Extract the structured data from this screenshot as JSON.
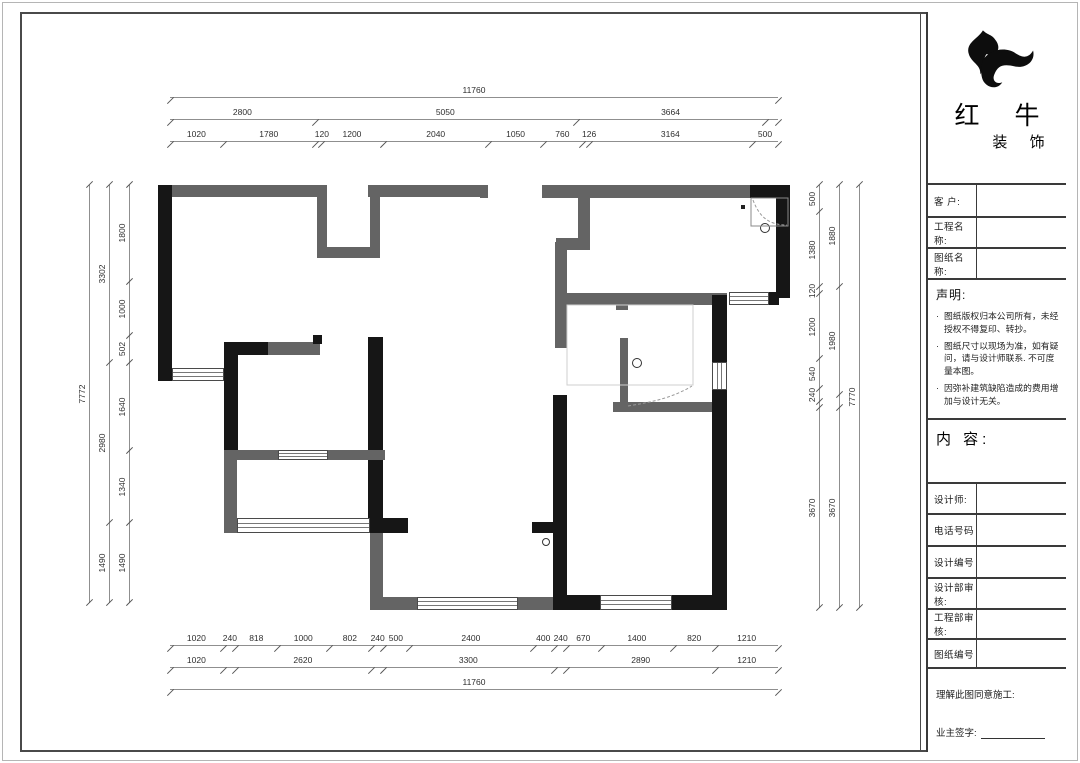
{
  "title_block": {
    "logo": {
      "icon": "bull-swoosh-logo",
      "name_main": "红 牛",
      "name_sub": "装 饰"
    },
    "fields_top": [
      {
        "label": "客  户:"
      },
      {
        "label": "工程名称:"
      },
      {
        "label": "图纸名称:"
      }
    ],
    "statement": {
      "title": "声明:",
      "bullet": "·",
      "items": [
        "图纸版权归本公司所有，未经授权不得复印、转抄。",
        "图纸尺寸以现场为准，如有疑问，请与设计师联系. 不可度量本图。",
        "因弥补建筑缺陷造成的费用增加与设计无关。"
      ]
    },
    "content_label": "内 容:",
    "fields_bottom": [
      {
        "label": "设计师:"
      },
      {
        "label": "电话号码"
      },
      {
        "label": "设计编号"
      },
      {
        "label": "设计部审核:"
      },
      {
        "label": "工程部审核:"
      },
      {
        "label": "图纸编号"
      }
    ],
    "signature": {
      "line1": "理解此图同意施工:",
      "line2": "业主签字:"
    }
  },
  "dims": {
    "top": [
      [
        [
          11760,
          "11760"
        ]
      ],
      [
        [
          2800,
          "2800"
        ],
        [
          5050,
          "5050"
        ],
        [
          3664,
          "3664"
        ],
        [
          246,
          ""
        ]
      ],
      [
        [
          1020,
          "1020"
        ],
        [
          1780,
          "1780"
        ],
        [
          120,
          "120"
        ],
        [
          1200,
          "1200"
        ],
        [
          2040,
          "2040"
        ],
        [
          1050,
          "1050"
        ],
        [
          760,
          "760"
        ],
        [
          126,
          "126"
        ],
        [
          3164,
          "3164"
        ],
        [
          500,
          "500"
        ]
      ]
    ],
    "bottom": [
      [
        [
          1020,
          "1020"
        ],
        [
          240,
          "240"
        ],
        [
          818,
          "818"
        ],
        [
          1000,
          "1000"
        ],
        [
          802,
          "802"
        ],
        [
          240,
          "240"
        ],
        [
          500,
          "500"
        ],
        [
          2400,
          "2400"
        ],
        [
          400,
          "400"
        ],
        [
          240,
          "240"
        ],
        [
          670,
          "670"
        ],
        [
          1400,
          "1400"
        ],
        [
          820,
          "820"
        ],
        [
          1210,
          "1210"
        ]
      ],
      [
        [
          1020,
          "1020"
        ],
        [
          240,
          ""
        ],
        [
          2620,
          "2620"
        ],
        [
          240,
          ""
        ],
        [
          3300,
          "3300"
        ],
        [
          240,
          ""
        ],
        [
          2890,
          "2890"
        ],
        [
          1210,
          "1210"
        ]
      ],
      [
        [
          11760,
          "11760"
        ]
      ]
    ],
    "left": [
      [
        [
          7772,
          "7772"
        ]
      ],
      [
        [
          3302,
          "3302"
        ],
        [
          2980,
          "2980"
        ],
        [
          1490,
          "1490"
        ]
      ],
      [
        [
          1800,
          "1800"
        ],
        [
          1000,
          "1000"
        ],
        [
          502,
          "502"
        ],
        [
          1640,
          "1640"
        ],
        [
          1340,
          "1340"
        ],
        [
          1490,
          "1490"
        ]
      ]
    ],
    "right": [
      [
        [
          500,
          "500"
        ],
        [
          1380,
          "1380"
        ],
        [
          120,
          "120"
        ],
        [
          1200,
          "1200"
        ],
        [
          540,
          "540"
        ],
        [
          240,
          "240"
        ],
        [
          120,
          ""
        ],
        [
          3670,
          "3670"
        ]
      ],
      [
        [
          1880,
          "1880"
        ],
        [
          1980,
          "1980"
        ],
        [
          240,
          ""
        ],
        [
          3670,
          "3670"
        ]
      ],
      [
        [
          7770,
          "7770"
        ]
      ]
    ]
  },
  "floor_plan": {
    "wall_colors": {
      "structural": "#161616",
      "existing": "#646464"
    },
    "walls": [
      [
        158,
        185,
        14,
        196,
        "b"
      ],
      [
        172,
        185,
        155,
        12,
        "g"
      ],
      [
        317,
        197,
        10,
        61,
        "g"
      ],
      [
        317,
        247,
        63,
        11,
        "g"
      ],
      [
        370,
        197,
        10,
        61,
        "g"
      ],
      [
        368,
        185,
        120,
        12,
        "g"
      ],
      [
        480,
        185,
        8,
        13,
        "g"
      ],
      [
        542,
        185,
        210,
        13,
        "g"
      ],
      [
        578,
        197,
        12,
        53,
        "g"
      ],
      [
        556,
        238,
        24,
        12,
        "g"
      ],
      [
        555,
        242,
        12,
        106,
        "g"
      ],
      [
        750,
        185,
        40,
        13,
        "b"
      ],
      [
        776,
        185,
        14,
        113,
        "b"
      ],
      [
        224,
        342,
        14,
        116,
        "b"
      ],
      [
        238,
        342,
        32,
        13,
        "b"
      ],
      [
        268,
        342,
        52,
        13,
        "g"
      ],
      [
        313,
        335,
        9,
        9,
        "b"
      ],
      [
        368,
        337,
        15,
        196,
        "b"
      ],
      [
        368,
        518,
        40,
        15,
        "b"
      ],
      [
        224,
        458,
        13,
        75,
        "g"
      ],
      [
        224,
        450,
        54,
        10,
        "g"
      ],
      [
        328,
        450,
        57,
        10,
        "g"
      ],
      [
        224,
        518,
        13,
        15,
        "g"
      ],
      [
        370,
        533,
        13,
        65,
        "g"
      ],
      [
        370,
        597,
        47,
        13,
        "g"
      ],
      [
        518,
        597,
        35,
        13,
        "g"
      ],
      [
        560,
        293,
        167,
        12,
        "g"
      ],
      [
        616,
        303,
        12,
        7,
        "g"
      ],
      [
        613,
        402,
        100,
        10,
        "g"
      ],
      [
        620,
        338,
        8,
        70,
        "g"
      ],
      [
        553,
        395,
        14,
        215,
        "b"
      ],
      [
        532,
        522,
        21,
        11,
        "b"
      ],
      [
        553,
        595,
        47,
        15,
        "b"
      ],
      [
        672,
        595,
        55,
        15,
        "b"
      ],
      [
        712,
        295,
        15,
        67,
        "b"
      ],
      [
        712,
        390,
        15,
        205,
        "b"
      ],
      [
        769,
        292,
        10,
        13,
        "b"
      ]
    ],
    "windows": [
      [
        172,
        368,
        52,
        13,
        "h"
      ],
      [
        278,
        450,
        50,
        10,
        "h"
      ],
      [
        237,
        518,
        133,
        15,
        "h"
      ],
      [
        417,
        597,
        101,
        13,
        "h"
      ],
      [
        600,
        595,
        72,
        15,
        "h"
      ],
      [
        712,
        362,
        15,
        28,
        "v"
      ],
      [
        729,
        292,
        40,
        13,
        "h"
      ]
    ],
    "drains": [
      [
        765,
        228,
        5
      ],
      [
        637,
        363,
        5
      ],
      [
        546,
        542,
        4
      ]
    ],
    "overlay": [
      {
        "n": "shower-enclosure",
        "d": "M751,198 H788 V226 H751 Z",
        "s": "#8a8a8a",
        "dash": "",
        "f": "none"
      },
      {
        "n": "shower-door-swing",
        "d": "M753,200 C760,219 771,225 787,225",
        "s": "#9a9a9a",
        "dash": "3,2",
        "f": "none"
      },
      {
        "n": "bathroom-zone-outline",
        "d": "M567,305 H693 V385 H567 Z",
        "s": "#cfcfcf",
        "dash": "",
        "f": "none"
      },
      {
        "n": "bath-door-swing",
        "d": "M628,406 C652,402 672,398 692,386",
        "s": "#9a9a9a",
        "dash": "3,2",
        "f": "none"
      },
      {
        "n": "wall-dot",
        "d": "M741,205 h4 v4 h-4 Z",
        "s": "none",
        "dash": "",
        "f": "#222"
      }
    ]
  }
}
